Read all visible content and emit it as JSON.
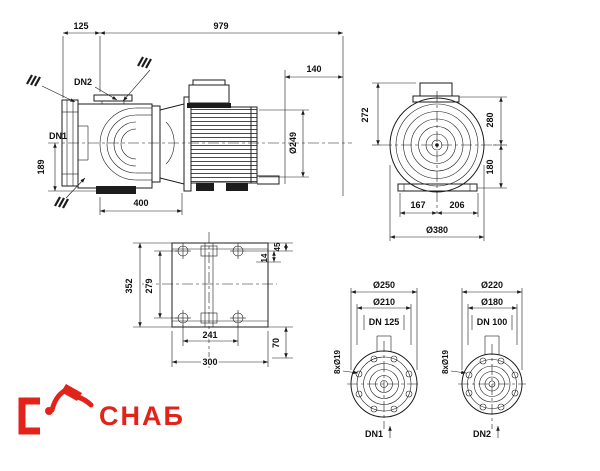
{
  "colors": {
    "line": "#1c1c1c",
    "text": "#111111",
    "red": "#e2231a",
    "bg": "#ffffff"
  },
  "side_view": {
    "d125": "125",
    "d979": "979",
    "d140": "140",
    "d249": "Ø249",
    "d189": "189",
    "d400": "400",
    "dn1": "DN1",
    "dn2": "DN2"
  },
  "fan_view": {
    "d272": "272",
    "d280": "280",
    "d180": "180",
    "d167": "167",
    "d206": "206",
    "d380": "Ø380"
  },
  "base_view": {
    "d352": "352",
    "d279": "279",
    "d45": "45",
    "d14": "14",
    "d70": "70",
    "d241": "241",
    "d300": "300"
  },
  "flange_dn1": {
    "outer": "Ø250",
    "bolt": "Ø210",
    "dn": "DN 125",
    "holes": "8xØ19",
    "label": "DN1"
  },
  "flange_dn2": {
    "outer": "Ø220",
    "bolt": "Ø180",
    "dn": "DN 100",
    "holes": "8xØ19",
    "label": "DN2"
  },
  "logo": {
    "text": "СНАБ"
  }
}
